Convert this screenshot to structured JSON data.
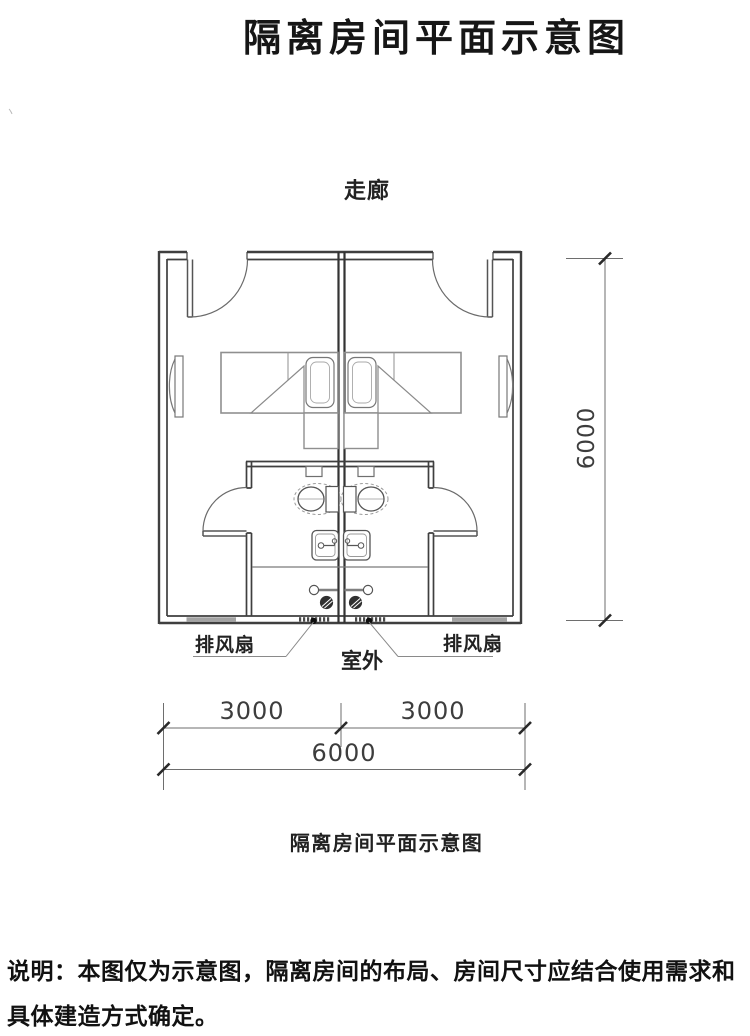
{
  "page": {
    "main_title": "隔离房间平面示意图",
    "stray_mark": "丶",
    "note_line1": "说明：本图仅为示意图，隔离房间的布局、房间尺寸应结合使用需求和",
    "note_line2": "具体建造方式确定。"
  },
  "plan": {
    "corridor_label": "走廊",
    "outdoor_label": "室外",
    "exhaust_fan_left": "排风扇",
    "exhaust_fan_right": "排风扇",
    "caption": "隔离房间平面示意图",
    "dimensions": {
      "bottom_left": "3000",
      "bottom_right": "3000",
      "bottom_total": "6000",
      "right_total": "6000"
    },
    "colors": {
      "wall_line": "#3f3f3f",
      "furniture_line": "#8f8f8f",
      "dimension_line": "#6e6e6e",
      "window_fill": "#a3a3a3",
      "text": "#161616"
    }
  }
}
